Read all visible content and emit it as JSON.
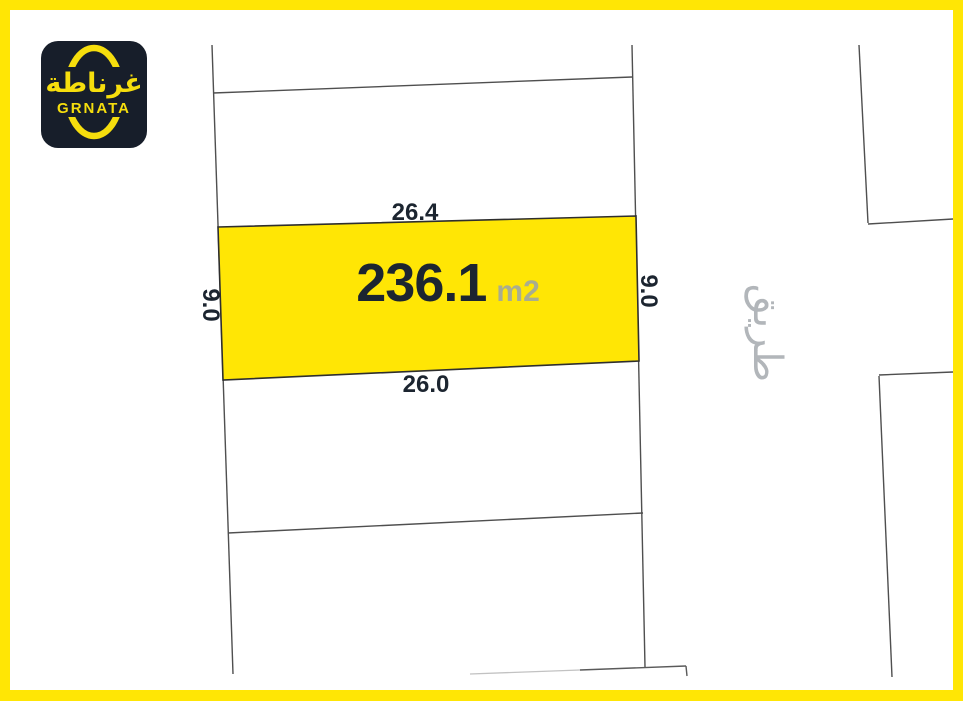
{
  "brand": {
    "logo_arabic": "غرناطة",
    "logo_latin": "GRNATA",
    "logo_icon": "oval-ring-icon"
  },
  "parcel": {
    "area_value": "236.1",
    "area_unit": "m2",
    "dim_top": "26.4",
    "dim_bottom": "26.0",
    "dim_left": "9.0",
    "dim_right": "9.0"
  },
  "road": {
    "label": "طريق"
  },
  "colors": {
    "frame_yellow": "#FFE605",
    "parcel_fill": "#FFE605",
    "parcel_outline": "#2E2E2E",
    "dark_navy_text": "#1C2530",
    "unit_gray": "#A9AD8F",
    "road_gray": "#B2B6BA",
    "boundary_line_gray": "#4F4F4F",
    "logo_background": "#171E2A",
    "logo_yellow": "#F6DE0D"
  }
}
